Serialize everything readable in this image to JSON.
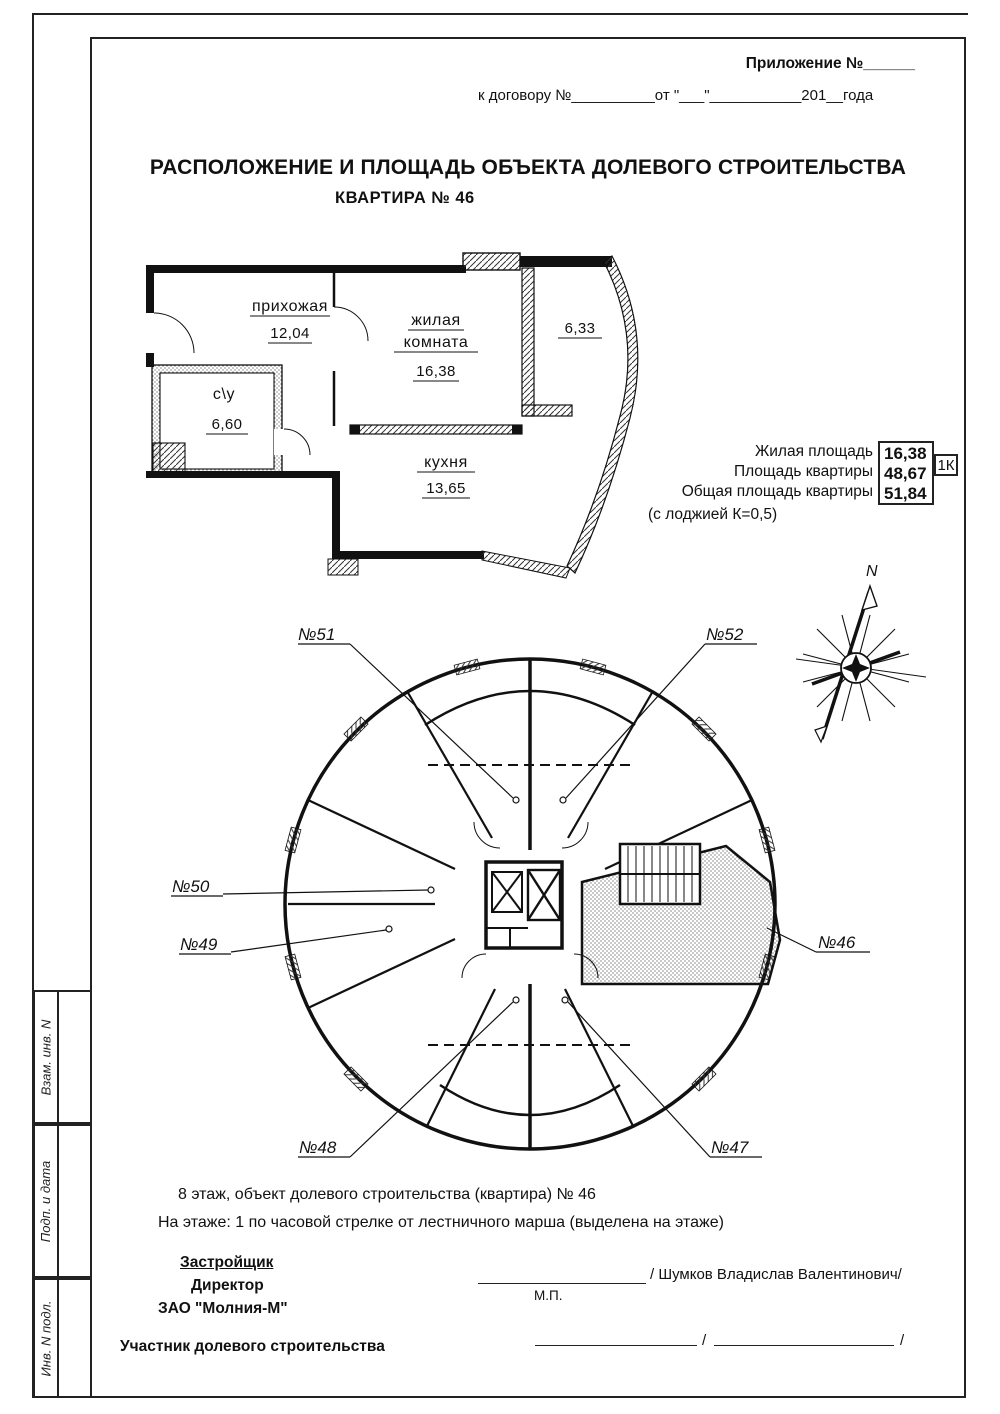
{
  "page": {
    "header": {
      "appendix": "Приложение №______",
      "contract": "к договору №__________от \"___\"___________201__года"
    },
    "title": "РАСПОЛОЖЕНИЕ И ПЛОЩАДЬ ОБЪЕКТА ДОЛЕВОГО СТРОИТЕЛЬСТВА",
    "subtitle": "КВАРТИРА № 46"
  },
  "apartment_plan": {
    "rooms": {
      "hallway": {
        "name": "прихожая",
        "area": "12,04"
      },
      "living": {
        "name_line1": "жилая",
        "name_line2": "комната",
        "area": "16,38"
      },
      "bathroom": {
        "name": "с\\у",
        "area": "6,60"
      },
      "kitchen": {
        "name": "кухня",
        "area": "13,65"
      },
      "loggia": {
        "area": "6,33"
      }
    }
  },
  "area_summary": {
    "rows": [
      {
        "label": "Жилая площадь",
        "value": "16,38"
      },
      {
        "label": "Площадь квартиры",
        "value": "48,67"
      },
      {
        "label": "Общая площадь квартиры",
        "value": "51,84"
      }
    ],
    "note": "(с лоджией К=0,5)",
    "apartment_type": "1К"
  },
  "compass": {
    "north": "N"
  },
  "floor_plan": {
    "labels": {
      "n51": "№51",
      "n52": "№52",
      "n50": "№50",
      "n49": "№49",
      "n46": "№46",
      "n48": "№48",
      "n47": "№47"
    }
  },
  "floor_info": {
    "line1": "8 этаж, объект долевого строительства (квартира) № 46",
    "line2": "На этаже:  1 по часовой стрелке от лестничного марша (выделена на этаже)"
  },
  "signatures": {
    "developer": {
      "heading": "Застройщик",
      "role": "Директор",
      "company": "ЗАО \"Молния-М\"",
      "name": "/ Шумков Владислав Валентинович/",
      "stamp": "М.П."
    },
    "participant": {
      "label": "Участник долевого строительства",
      "slash": "/"
    }
  },
  "sidebar": {
    "cell1": "Взам. инв. N",
    "cell2": "Подп. и дата",
    "cell3": "Инв. N подл."
  }
}
